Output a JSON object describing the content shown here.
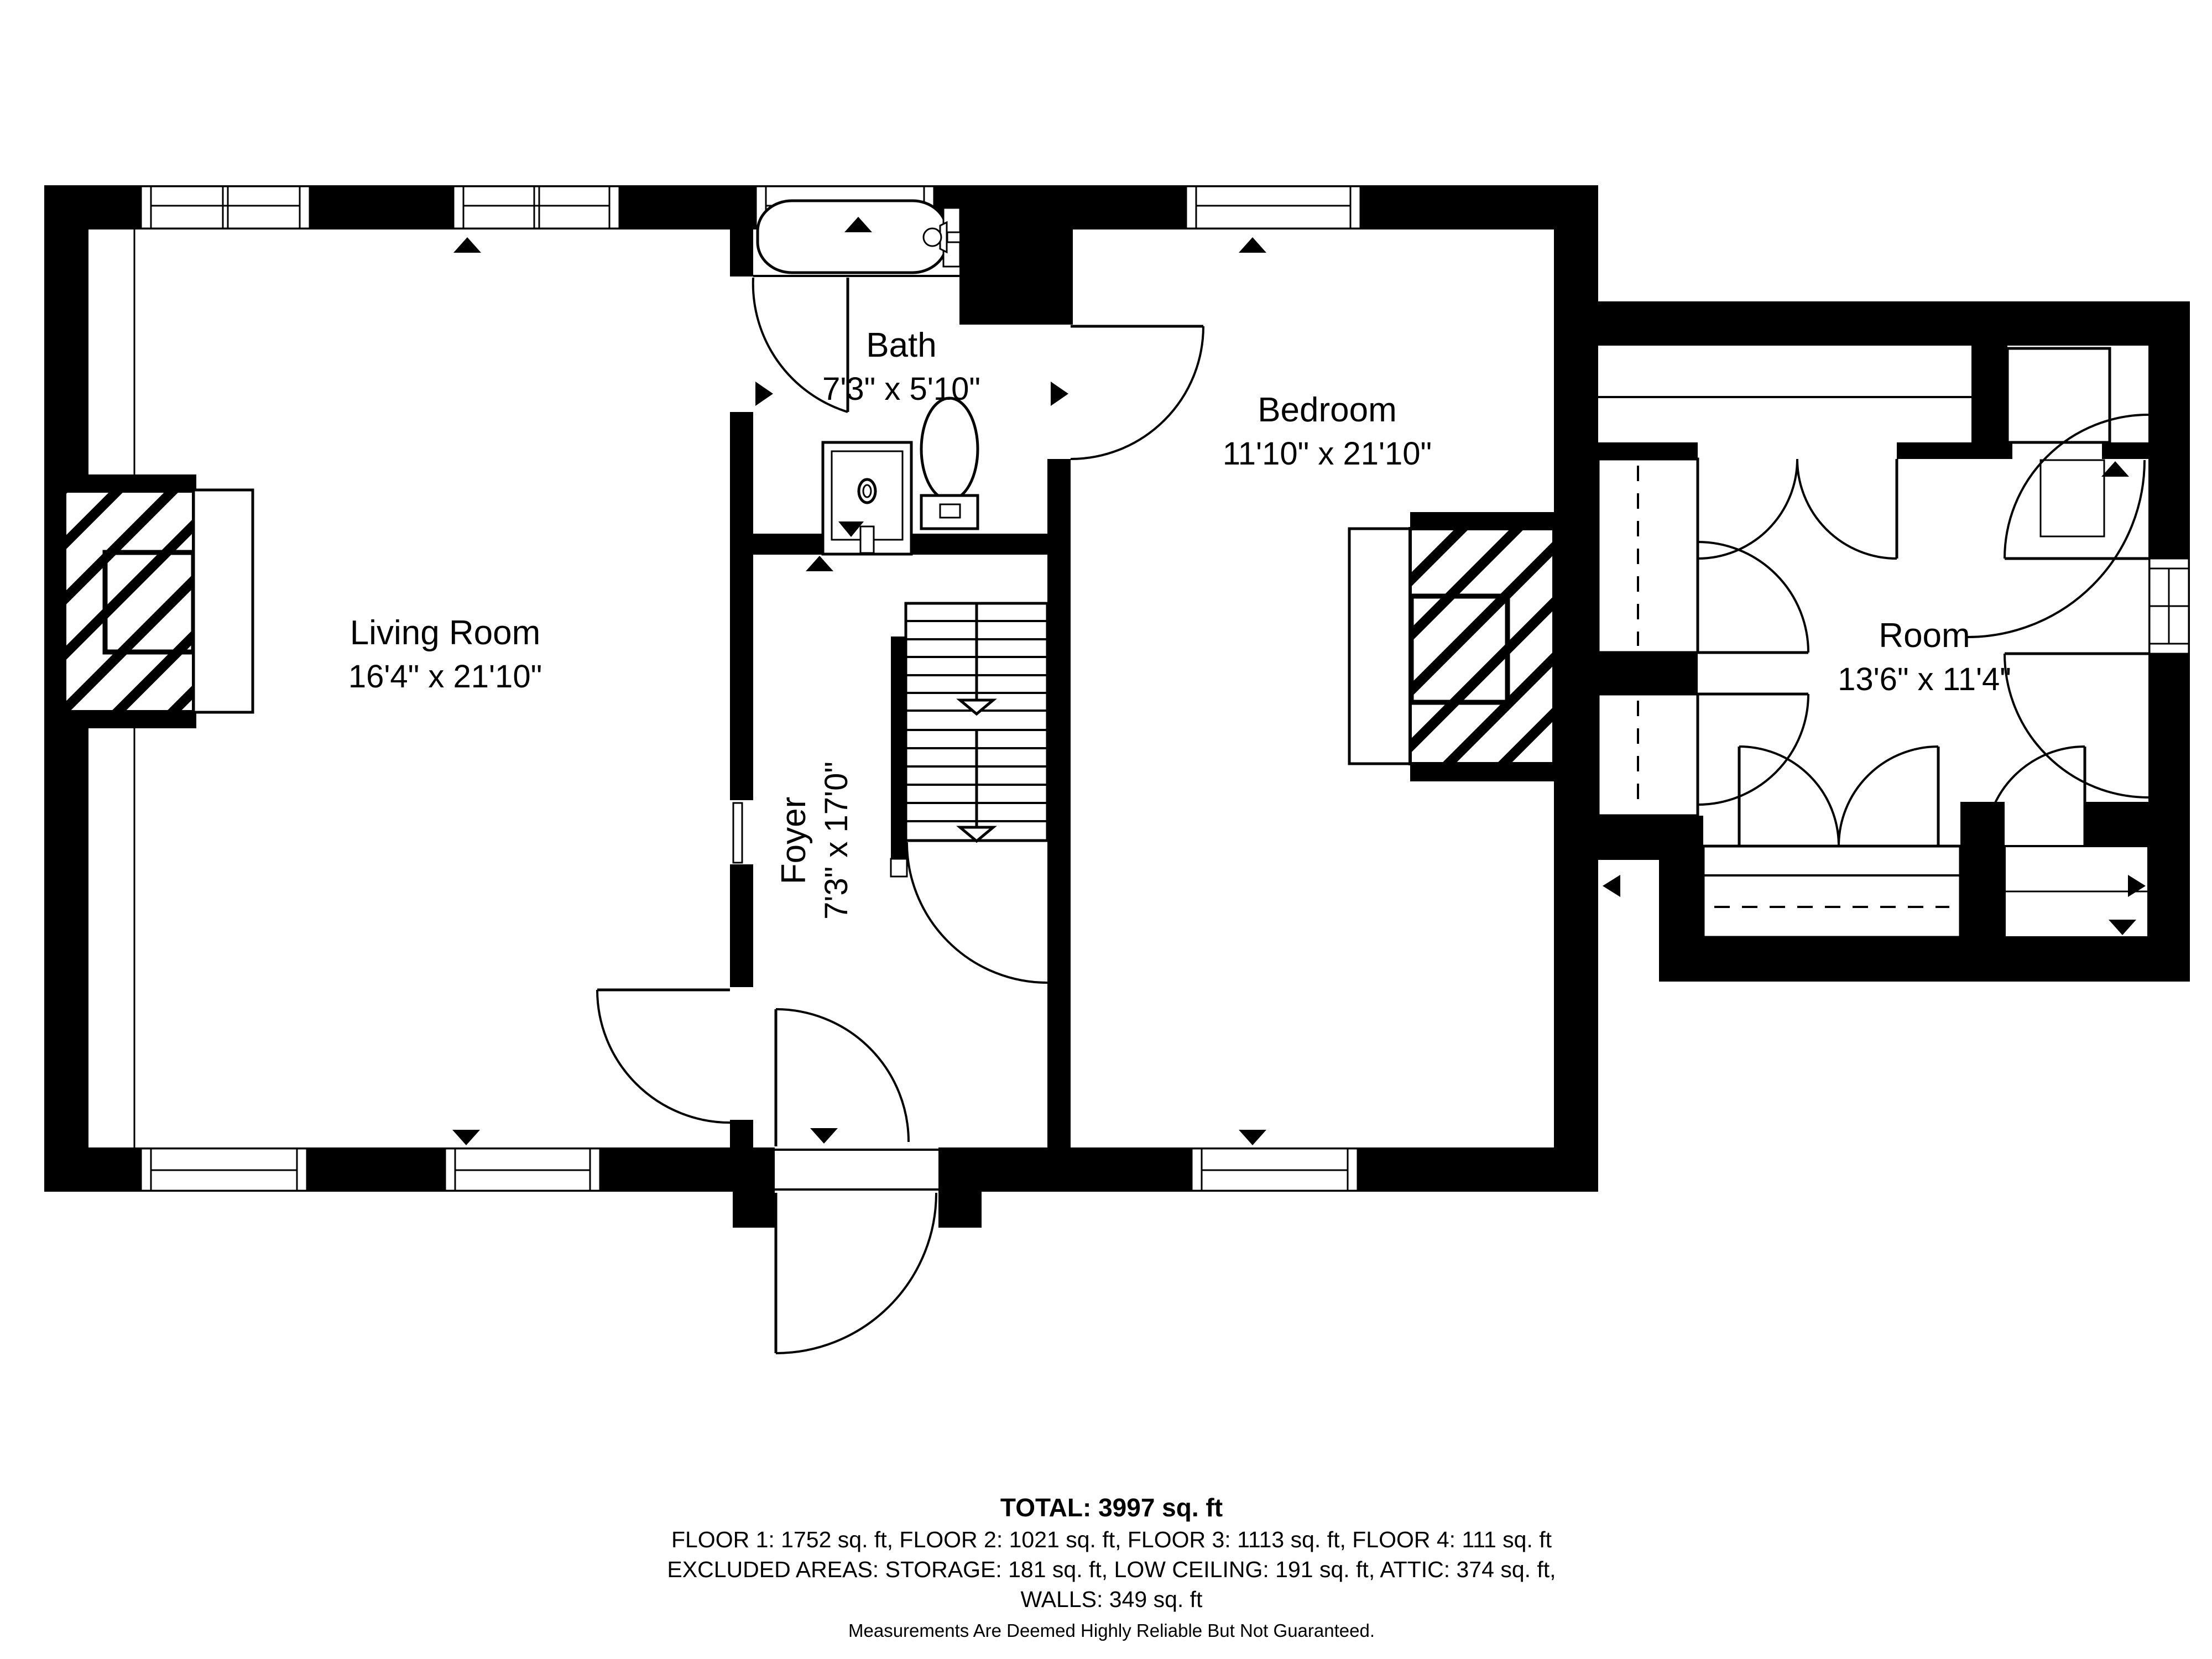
{
  "colors": {
    "wall": "#000000",
    "background": "#ffffff",
    "text": "#000000"
  },
  "rooms": {
    "living": {
      "name": "Living Room",
      "dims": "16'4\" x 21'10\""
    },
    "bath": {
      "name": "Bath",
      "dims": "7'3\" x 5'10\""
    },
    "bedroom": {
      "name": "Bedroom",
      "dims": "11'10\" x 21'10\""
    },
    "foyer": {
      "name": "Foyer",
      "dims": "7'3\" x 17'0\""
    },
    "room": {
      "name": "Room",
      "dims": "13'6\" x 11'4\""
    }
  },
  "summary": {
    "total": "TOTAL: 3997 sq. ft",
    "floors": "FLOOR 1: 1752 sq. ft, FLOOR 2: 1021 sq. ft, FLOOR 3: 1113 sq. ft, FLOOR 4: 111 sq. ft",
    "excluded": "EXCLUDED AREAS: STORAGE: 181 sq. ft, LOW CEILING: 191 sq. ft, ATTIC: 374 sq. ft,",
    "walls": "WALLS: 349 sq. ft",
    "disclaimer": "Measurements Are Deemed Highly Reliable But Not Guaranteed."
  }
}
